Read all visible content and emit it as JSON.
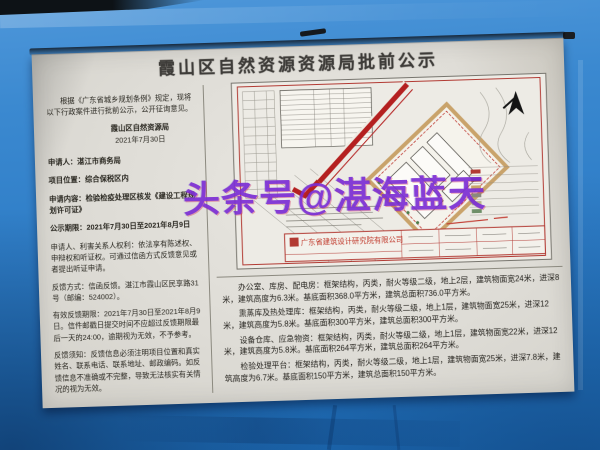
{
  "photo": {
    "watermark": "头条号@湛海蓝天"
  },
  "notice": {
    "title": "霞山区自然资源资源局批前公示",
    "intro": "根据《广东省城乡规划条例》规定，现将以下行政案件进行批前公示，公开征询意见。",
    "issuer": "霞山区自然资源局",
    "issue_date": "2021年7月30日",
    "fields": [
      "申请人：湛江市商务局",
      "项目位置：综合保税区内",
      "申请内容：检验检疫处理区核发《建设工程规划许可证》",
      "公示期限：2021年7月30日至2021年8月9日"
    ],
    "rights": "申请人、利害关系人权利：依法享有陈述权、申辩权和听证权。可通过信函方式反馈意见或者提出听证申请。",
    "feedback_method": "反馈方式：信函反馈。湛江市霞山区民享路31号（邮编：524002）。",
    "feedback_deadline": "有效反馈期限：2021年7月30日至2021年8月9日。信件邮戳日提交时间不应超过反馈期限最后一天的24:00，逾期视为无效，不予参考。",
    "feedback_notes": "反馈须知：反馈信息必须注明项目位置和真实姓名、联系电话、联系地址、邮政编码。如反馈信息不准确或不完整，导致无法核实有关情况的视为无效。"
  },
  "buildings": [
    "办公室、库房、配电房：框架结构，丙类，耐火等级二级，地上2层，建筑物面宽24米，进深8米，建筑高度为6.3米。基底面积368.0平方米，建筑总面积736.0平方米。",
    "熏蒸库及热处理库：框架结构，丙类，耐火等级二级，地上1层，建筑物面宽25米，进深12米，建筑高度为5.8米。基底面积300平方米，建筑总面积300平方米。",
    "设备仓库、应急物资：框架结构，丙类，耐火等级二级，地上1层，建筑物面宽22米，进深12米，建筑高度为5.8米。基底面积264平方米，建筑总面积264平方米。",
    "检验处理平台：框架结构，丙类，耐火等级二级，地上1层，建筑物面宽25米，进深7.8米，建筑高度为6.7米。基底面积150平方米，建筑总面积150平方米。"
  ],
  "site_plan": {
    "design_firm": "广东省建筑设计研究院有限公司"
  },
  "colors": {
    "tarp_blue": "#2d7cc6",
    "paper": "#dedcd6",
    "drawing_red": "#b23a33",
    "boundary_tan": "#c9a36b",
    "watermark_purple": "#7c2ed4"
  }
}
